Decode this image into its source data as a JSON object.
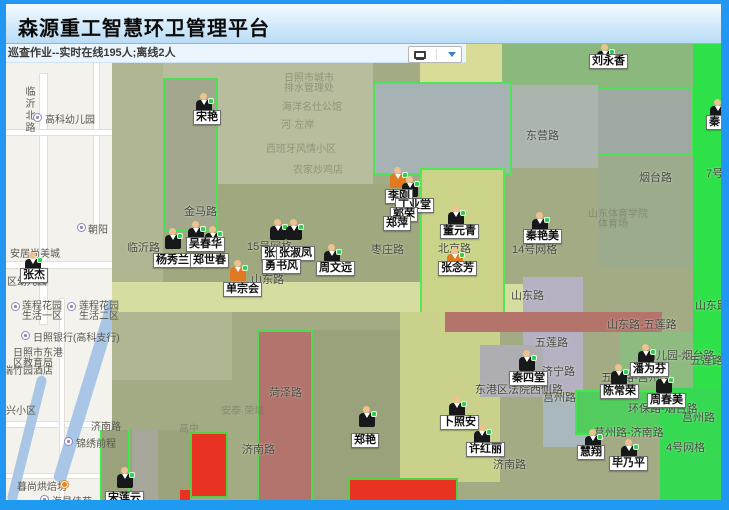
{
  "app": {
    "title": "森源重工智慧环卫管理平台"
  },
  "status": {
    "text": "巡查作业--实时在线195人;离线2人",
    "online_count": "195",
    "offline_count": "2"
  },
  "toolbar": {
    "icons": [
      "monitor-icon",
      "dropdown-arrow-icon"
    ]
  },
  "markers": [
    {
      "name": "宋艳",
      "variant": "dark"
    },
    {
      "name": "张杰",
      "variant": "dark"
    },
    {
      "name": "吴春华",
      "variant": "dark"
    },
    {
      "name": "杨秀兰",
      "variant": "dark"
    },
    {
      "name": "郑世春",
      "variant": "dark"
    },
    {
      "name": "张伟",
      "variant": "dark"
    },
    {
      "name": "张淑凤",
      "variant": "dark"
    },
    {
      "name": "勇书风",
      "variant": "dark"
    },
    {
      "name": "单宗会",
      "variant": "orange"
    },
    {
      "name": "周文远",
      "variant": "dark"
    },
    {
      "name": "李刚",
      "variant": "orange"
    },
    {
      "name": "丁业堂",
      "variant": "dark"
    },
    {
      "name": "郭荣",
      "variant": "dark"
    },
    {
      "name": "郑萍",
      "variant": "dark"
    },
    {
      "name": "董元青",
      "variant": "dark"
    },
    {
      "name": "张念芳",
      "variant": "orange"
    },
    {
      "name": "秦艳美",
      "variant": "dark"
    },
    {
      "name": "刘永香",
      "variant": "dark"
    },
    {
      "name": "秦",
      "variant": "dark"
    },
    {
      "name": "秦四堂",
      "variant": "dark"
    },
    {
      "name": "陈常荣",
      "variant": "dark"
    },
    {
      "name": "潘为芬",
      "variant": "dark"
    },
    {
      "name": "周春美",
      "variant": "dark"
    },
    {
      "name": "卜照安",
      "variant": "dark"
    },
    {
      "name": "许红丽",
      "variant": "dark"
    },
    {
      "name": "郑艳",
      "variant": "dark"
    },
    {
      "name": "慧翔",
      "variant": "dark"
    },
    {
      "name": "毕乃平",
      "variant": "dark"
    },
    {
      "name": "宋莲云",
      "variant": "dark"
    }
  ],
  "road_labels": [
    "金马路",
    "临沂路",
    "山东路",
    "枣庄路",
    "北京路",
    "东营路",
    "烟台路",
    "14号网格",
    "15号网格",
    "7号网格",
    "山东路",
    "山东路",
    "山东路-五莲路",
    "五莲路",
    "济宁路",
    "五莲路-莒州路",
    "幼儿园-烟台路",
    "五莲路",
    "东港区法院西侧路",
    "莒州路",
    "环保路-烟台路",
    "莒州路",
    "莒州路-济南路",
    "菏泽路",
    "济南路",
    "济南路",
    "4号网格"
  ],
  "base_map_labels": [
    "临沂北路",
    "高科幼儿园",
    "朝阳",
    "安居尚美城",
    "区幼儿园",
    "莲程花园",
    "生活一区",
    "莲程花园",
    "生活二区",
    "日照银行(高科支行)",
    "日照市东港",
    "区教育局",
    "瑞竹园酒店",
    "兴小区",
    "济南路",
    "锦绣前程",
    "暮尚烘焙坊",
    "海星佳苑"
  ],
  "faint_labels": [
    "日照市城市",
    "排水管理处",
    "海洋名仕公馆",
    "河·左岸",
    "西班牙风情小区",
    "农家炒鸡店",
    "山东体育学院",
    "体育场",
    "安泰·荣域",
    "高中"
  ],
  "colors": {
    "frame_blue": "#2196f3",
    "header_gradient_top": "#f3fbff",
    "header_gradient_bottom": "#b9dcf6",
    "status_bg": "#eaf5fd",
    "overlay_olive": "#a3ab84",
    "overlay_yellow": "#cbd388",
    "overlay_gray_blue": "#a7b2b4",
    "overlay_red": "#e83323",
    "overlay_red_brown": "#b2746c",
    "overlay_green_bright": "#2fe148",
    "overlay_lavender": "#b6b1c2",
    "overlay_border_green": "#3deb4b",
    "marker_badge_green": "#2fd14b",
    "marker_orange": "#e0791f"
  }
}
